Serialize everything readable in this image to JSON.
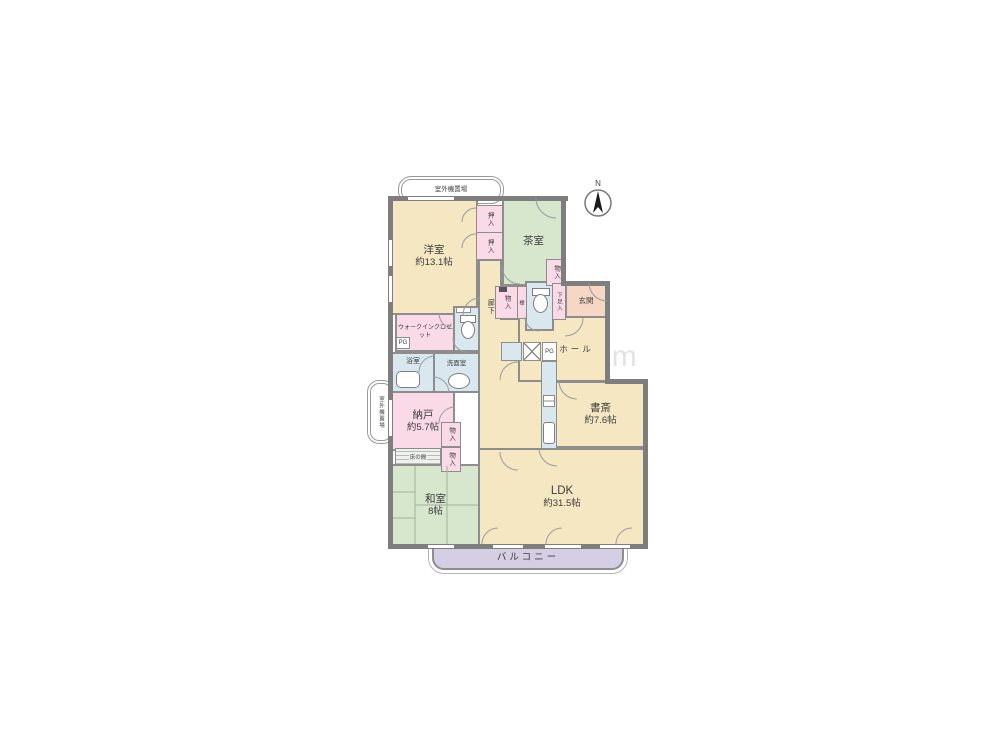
{
  "watermark": "ienakanote.com",
  "compass": {
    "north": "N"
  },
  "outdoor_unit_top": "室外機置場",
  "outdoor_unit_left": "室外機置場",
  "balcony": "バルコニー",
  "rooms": {
    "yoshitsu": {
      "name": "洋室",
      "size": "約13.1帖"
    },
    "chashitsu": {
      "name": "茶室"
    },
    "genkan": {
      "name": "玄関"
    },
    "hall": {
      "name": "ホール"
    },
    "rouka": {
      "name": "廊下"
    },
    "wic": {
      "name": "ウォークインクロゼット"
    },
    "yokushitsu": {
      "name": "浴室"
    },
    "senmenshitsu": {
      "name": "洗面室"
    },
    "nando": {
      "name": "納戸",
      "size": "約5.7帖"
    },
    "washitsu": {
      "name": "和室",
      "size": "8帖"
    },
    "shosai": {
      "name": "書斎",
      "size": "約7.6帖"
    },
    "ldk": {
      "name": "LDK",
      "size": "約31.5帖"
    }
  },
  "storage": {
    "oshiire1": "押入",
    "oshiire2": "押入",
    "monoire_tea": "物入",
    "monoire_hall": "物入",
    "monoire_nando1": "物入",
    "monoire_nando2": "物入",
    "getabako": "下足入",
    "tana": "棚",
    "tokonoma": "床の間"
  },
  "utility": {
    "pg1": "PG",
    "pg2": "PG"
  },
  "colors": {
    "wall": "#7e7e7e",
    "room_beige": "#f6e7c3",
    "room_green": "#d6e7cd",
    "closet_pink": "#f9dae6",
    "entry_salmon": "#f6d7c3",
    "wet_blue": "#d8e8ee",
    "balcony_lavender": "#d5cfe5"
  }
}
